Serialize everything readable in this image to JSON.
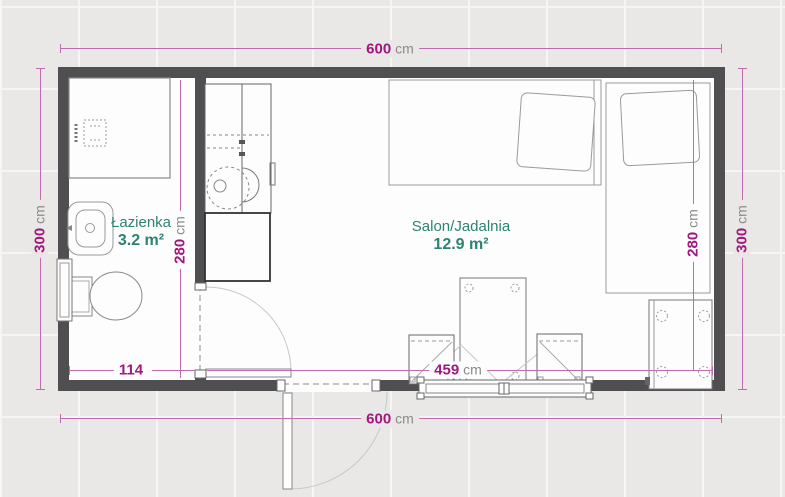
{
  "title": "Floor plan - small apartment",
  "colors": {
    "dimension": "#a1177f",
    "dimension_line": "#c06ab0",
    "unit": "#8b8b8b",
    "room_label": "#2e8274",
    "wall": "#4f4e50",
    "bg": "#e9e8e6"
  },
  "rooms": {
    "bathroom": {
      "name": "Łazienka",
      "area": "3.2 m²"
    },
    "salon": {
      "name": "Salon/Jadalnia",
      "area": "12.9 m²"
    }
  },
  "dimensions": {
    "top": {
      "value": "600",
      "unit": "cm"
    },
    "bottom": {
      "value": "600",
      "unit": "cm"
    },
    "left": {
      "value": "300",
      "unit": "cm"
    },
    "right": {
      "value": "300",
      "unit": "cm"
    },
    "bathroom_width": {
      "value": "114",
      "unit": ""
    },
    "salon_width": {
      "value": "459",
      "unit": "cm"
    },
    "bathroom_height": {
      "value": "280",
      "unit": "cm"
    },
    "salon_height": {
      "value": "280",
      "unit": "cm"
    }
  }
}
